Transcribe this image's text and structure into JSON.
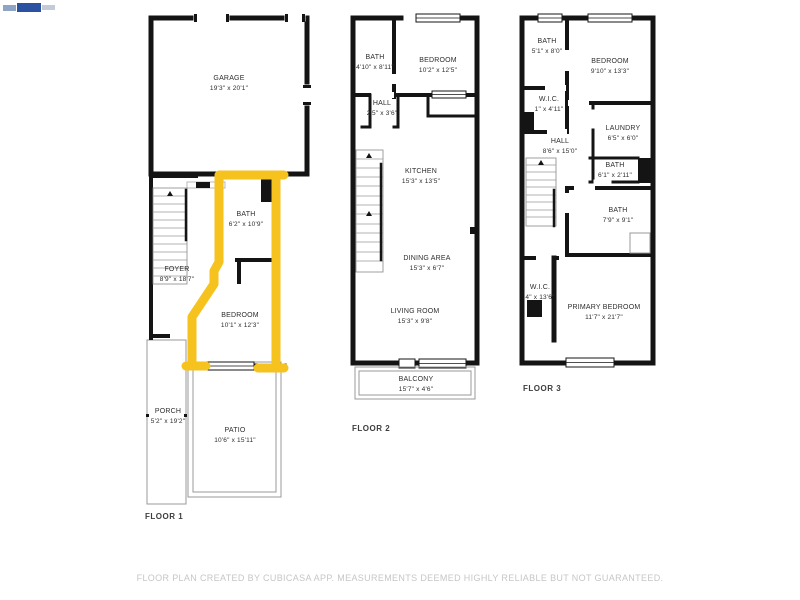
{
  "colors": {
    "wall": "#141414",
    "highlight": "#f5c21e",
    "room_text": "#2e2e2e",
    "floor_label_text": "#3d3d3d",
    "disclaimer_text": "#c6c6c6",
    "watermark_blue": "#2b52a0"
  },
  "icons": {
    "watermark": "listing-watermark-logo"
  },
  "floors": [
    {
      "label": "FLOOR 1",
      "rooms": [
        {
          "name": "GARAGE",
          "dims": "19'3\" x 20'1\""
        },
        {
          "name": "BATH",
          "dims": "6'2\" x 10'9\""
        },
        {
          "name": "FOYER",
          "dims": "8'9\" x 18'7\""
        },
        {
          "name": "BEDROOM",
          "dims": "10'1\" x 12'3\""
        },
        {
          "name": "PORCH",
          "dims": "5'2\" x 19'2\""
        },
        {
          "name": "PATIO",
          "dims": "10'6\" x 15'11\""
        }
      ]
    },
    {
      "label": "FLOOR 2",
      "rooms": [
        {
          "name": "BATH",
          "dims": "4'10\" x 8'11\""
        },
        {
          "name": "BEDROOM",
          "dims": "10'2\" x 12'5\""
        },
        {
          "name": "HALL",
          "dims": "2'5\" x 3'6\""
        },
        {
          "name": "KITCHEN",
          "dims": "15'3\" x 13'5\""
        },
        {
          "name": "DINING AREA",
          "dims": "15'3\" x 6'7\""
        },
        {
          "name": "LIVING ROOM",
          "dims": "15'3\" x 9'8\""
        },
        {
          "name": "BALCONY",
          "dims": "15'7\" x 4'6\""
        }
      ]
    },
    {
      "label": "FLOOR 3",
      "rooms": [
        {
          "name": "BATH",
          "dims": "5'1\" x 8'0\""
        },
        {
          "name": "BEDROOM",
          "dims": "9'10\" x 13'3\""
        },
        {
          "name": "W.I.C.",
          "dims": "1\" x 4'11\""
        },
        {
          "name": "LAUNDRY",
          "dims": "6'5\" x 6'0\""
        },
        {
          "name": "HALL",
          "dims": "8'6\" x 15'0\""
        },
        {
          "name": "BATH",
          "dims": "6'1\" x 2'11\""
        },
        {
          "name": "BATH",
          "dims": "7'9\" x 9'1\""
        },
        {
          "name": "W.I.C.",
          "dims": "4\" x 13'6\""
        },
        {
          "name": "PRIMARY BEDROOM",
          "dims": "11'7\" x 21'7\""
        }
      ]
    }
  ],
  "footer": {
    "disclaimer": "FLOOR PLAN CREATED BY CUBICASA APP. MEASUREMENTS DEEMED HIGHLY RELIABLE BUT NOT GUARANTEED."
  }
}
